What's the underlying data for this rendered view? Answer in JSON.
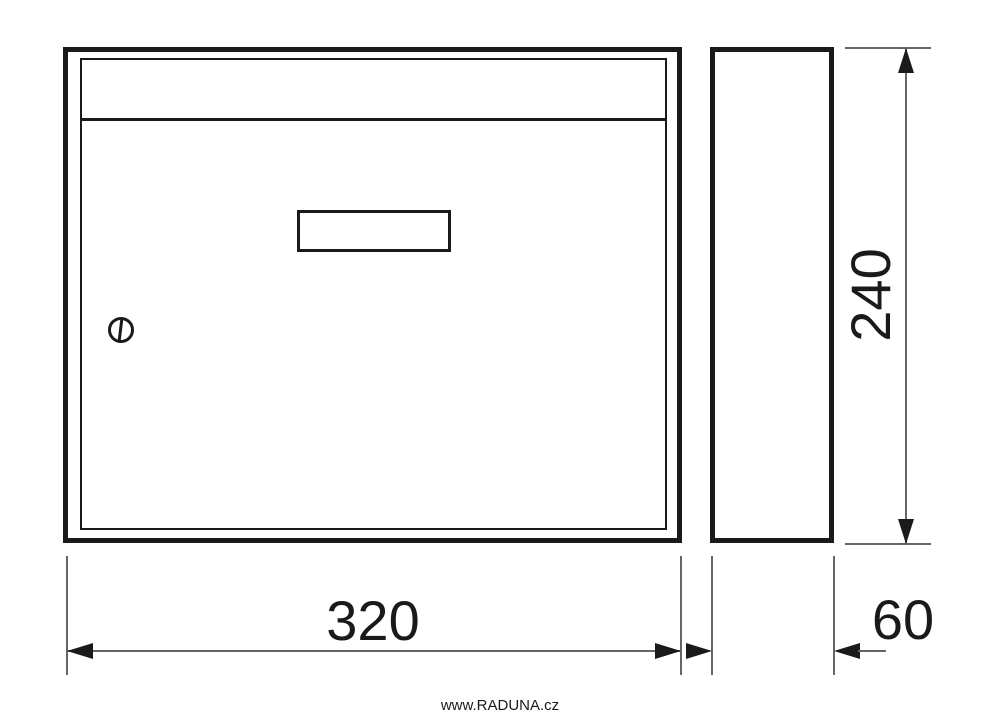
{
  "colors": {
    "ink": "#1a1a1a",
    "thin_line": "#666666",
    "background": "#ffffff"
  },
  "drawing": {
    "subject": "mailbox-technical-drawing",
    "dimensions": {
      "width": {
        "value": "320"
      },
      "height": {
        "value": "240"
      },
      "depth": {
        "value": "60"
      }
    }
  },
  "watermark": {
    "text": "www.RADUNA.cz"
  }
}
